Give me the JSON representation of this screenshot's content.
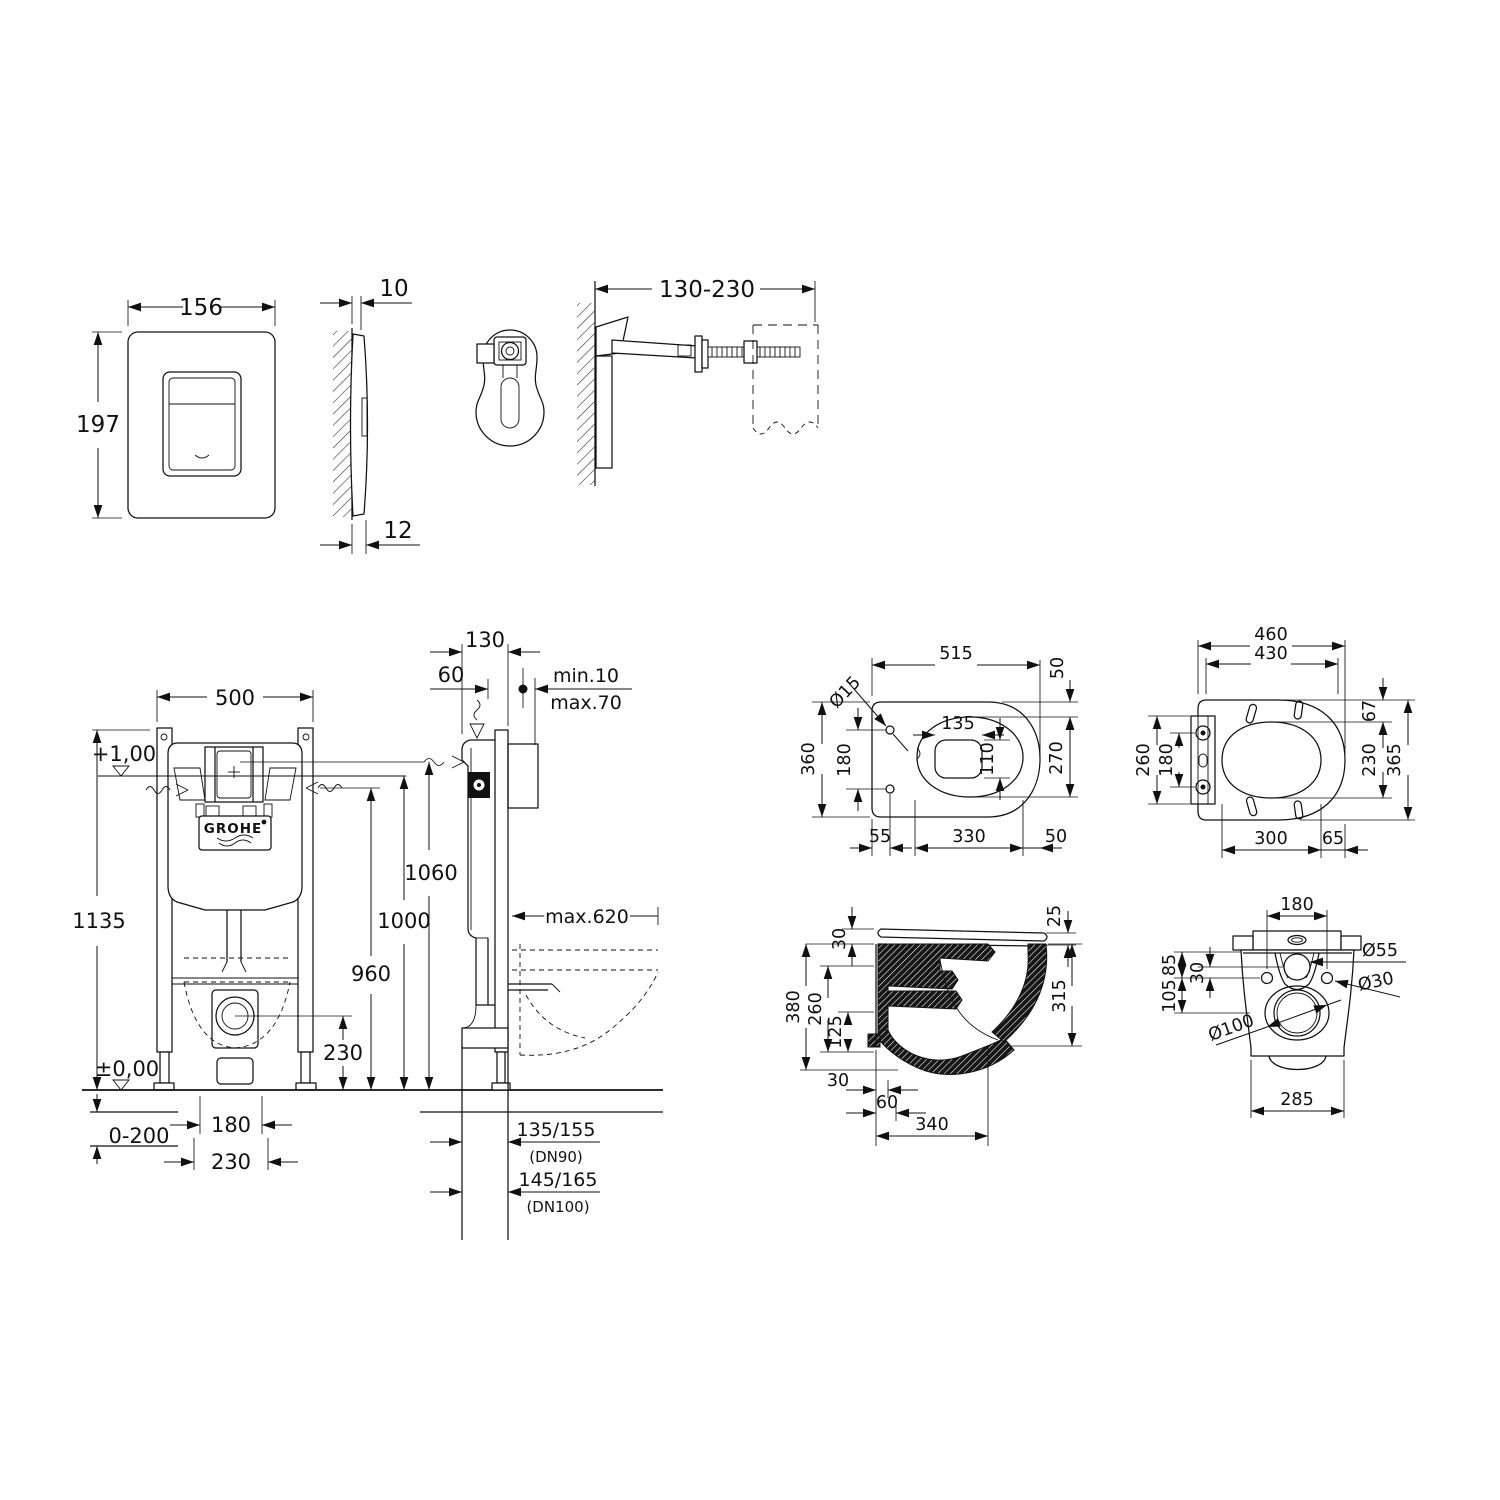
{
  "flush_plate": {
    "front": {
      "width": "156",
      "height": "197"
    },
    "side": {
      "gap_top": "10",
      "thickness_bottom": "12"
    }
  },
  "wall_bracket": {
    "adjust_range": "130-230"
  },
  "frame_front": {
    "width": "500",
    "height": "1135",
    "level_plus": "+1,00",
    "level_zero": "±0,00",
    "floor_adjust": "0-200",
    "bolt_spacing": "180",
    "fixing_spacing": "230",
    "outlet_height": "230",
    "brand": "GROHE"
  },
  "frame_side": {
    "frame_depth": "130",
    "front_offset": "60",
    "wall_min": "min.10",
    "wall_max": "max.70",
    "flush_height": "1060",
    "top_height": "1000",
    "inlet_height": "960",
    "side_clearance": "max.620",
    "outlet_dn90": "135/155",
    "outlet_dn90_note": "(DN90)",
    "outlet_dn100": "145/165",
    "outlet_dn100_note": "(DN100)"
  },
  "bowl_top_view": {
    "length": "515",
    "back_gap": "50",
    "width": "360",
    "hole_spacing": "180",
    "inner_width": "135",
    "inner_depth": "110",
    "rim_width": "270",
    "hole_offset": "55",
    "rim_length": "330",
    "front_gap": "50",
    "hole_diameter": "Ø15"
  },
  "seat_top_view": {
    "length": "460",
    "lid_length": "430",
    "hinge_width": "260",
    "hinge_spacing": "180",
    "back_gap": "67",
    "ring_width": "230",
    "width": "365",
    "ring_length": "300",
    "front_gap": "65"
  },
  "bowl_side_view": {
    "seat_height": "30",
    "lid_edge": "25",
    "height": "380",
    "bowl_depth": "260",
    "water_depth": "125",
    "front_height": "315",
    "wall_gap": "30",
    "outlet_offset": "60",
    "depth": "340"
  },
  "bowl_rear_view": {
    "hole_spacing": "180",
    "top_to_hole": "85",
    "inlet_to_hole": "30",
    "hole_to_outlet": "105",
    "inlet_diameter": "Ø55",
    "hole_diameter": "Ø30",
    "outlet_diameter": "Ø100",
    "width": "285"
  }
}
